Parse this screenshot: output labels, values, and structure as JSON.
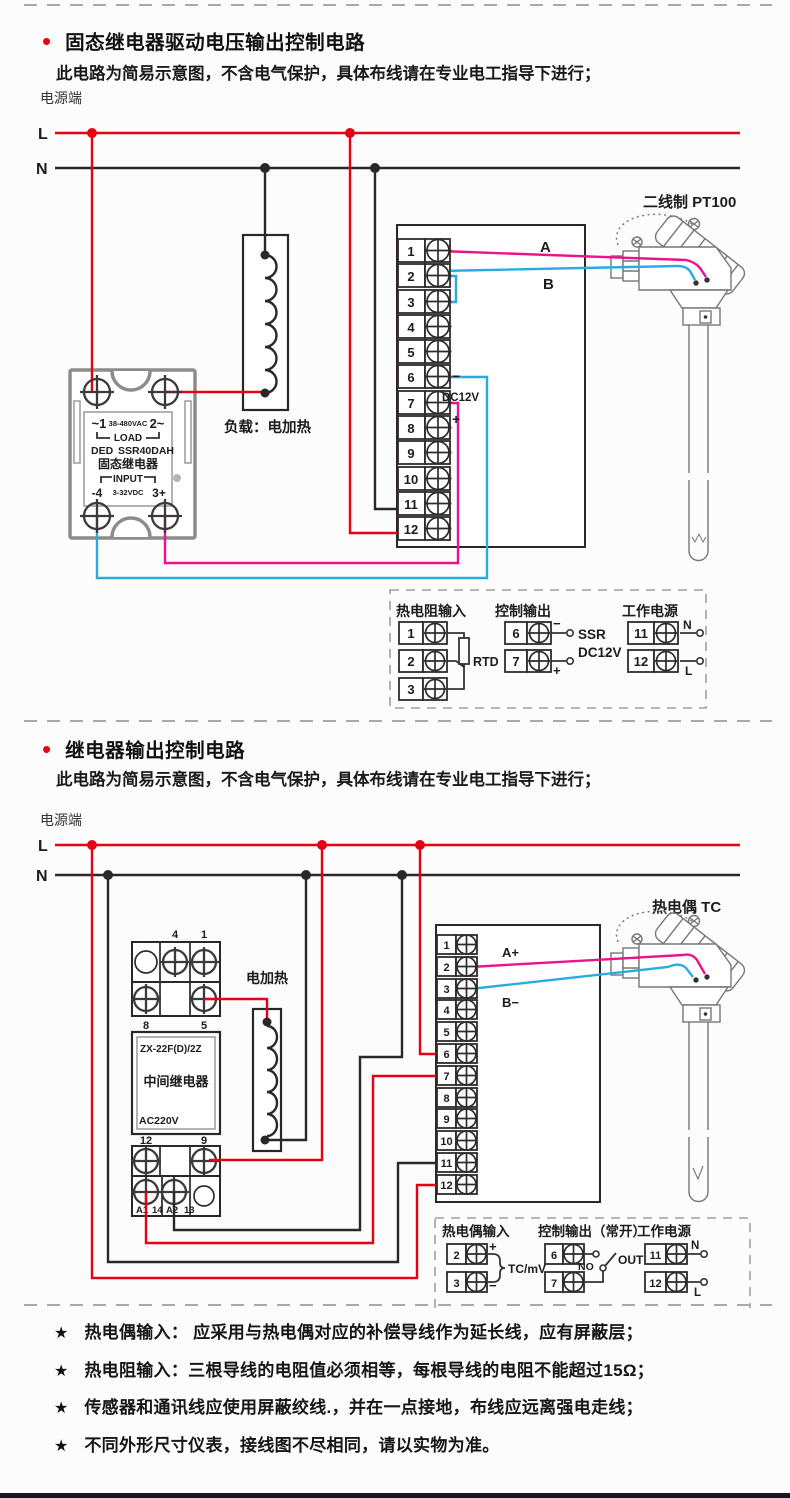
{
  "s1": {
    "bullet": "•",
    "title": "固态继电器驱动电压输出控制电路",
    "subtitle": "此电路为简易示意图，不含电气保护，具体布线请在专业电工指导下进行；",
    "power_end": "电源端",
    "l": "L",
    "n": "N",
    "t": [
      "1",
      "2",
      "3",
      "4",
      "5",
      "6",
      "7",
      "8",
      "9",
      "10",
      "11",
      "12"
    ],
    "wire_a": "A",
    "wire_b": "B",
    "minus": "−",
    "plus": "+",
    "dc12v": "DC12V",
    "ssr": {
      "pin1": "~1",
      "vac": "38-480VAC",
      "pin2": "2~",
      "load": "LOAD",
      "brand": "DED",
      "model": "SSR40DAH",
      "name": "固态继电器",
      "input": "INPUT",
      "pin4": "-4",
      "vdc": "3-32VDC",
      "pin3": "3+"
    },
    "load_label": "负载：电加热",
    "sensor_label": "二线制 PT100",
    "legend": {
      "c1_title": "热电阻输入",
      "c1_terms": [
        "1",
        "2",
        "3"
      ],
      "rtd": "RTD",
      "c2_title": "控制输出",
      "c2_terms": [
        "6",
        "7"
      ],
      "c2_minus": "−",
      "c2_plus": "+",
      "ssr": "SSR",
      "dc12v": "DC12V",
      "c3_title": "工作电源",
      "c3_terms": [
        "11",
        "12"
      ],
      "n": "N",
      "l": "L"
    }
  },
  "s2": {
    "bullet": "•",
    "title": "继电器输出控制电路",
    "subtitle": "此电路为简易示意图，不含电气保护，具体布线请在专业电工指导下进行；",
    "power_end": "电源端",
    "l": "L",
    "n": "N",
    "t": [
      "1",
      "2",
      "3",
      "4",
      "5",
      "6",
      "7",
      "8",
      "9",
      "10",
      "11",
      "12"
    ],
    "wire_a": "A+",
    "wire_b": "B−",
    "heater_label": "电加热",
    "sensor_label": "热电偶 TC",
    "relay": {
      "p4": "4",
      "p1": "1",
      "p8": "8",
      "p5": "5",
      "model": "ZX-22F(D)/2Z",
      "name": "中间继电器",
      "volt": "AC220V",
      "p12": "12",
      "p9": "9",
      "a1": "A1",
      "p14": "14",
      "a2": "A2",
      "p13": "13"
    },
    "legend": {
      "c1_title": "热电偶输入",
      "c1_terms": [
        "2",
        "3"
      ],
      "c1_plus": "+",
      "c1_minus": "−",
      "tcmv": "TC/mV",
      "c2_title": "控制输出（常开）",
      "c2_terms": [
        "6",
        "7"
      ],
      "no": "NO",
      "out": "OUT",
      "c3_title": "工作电源",
      "c3_terms": [
        "11",
        "12"
      ],
      "n": "N",
      "l": "L"
    }
  },
  "notes": [
    {
      "star": "★",
      "text": "热电偶输入： 应采用与热电偶对应的补偿导线作为延长线，应有屏蔽层；"
    },
    {
      "star": "★",
      "text": "热电阻输入：三根导线的电阻值必须相等，每根导线的电阻不能超过15Ω；"
    },
    {
      "star": "★",
      "text": "传感器和通讯线应使用屏蔽绞线.，并在一点接地，布线应远离强电走线；"
    },
    {
      "star": "★",
      "text": "不同外形尺寸仪表，接线图不尽相同，请以实物为准。"
    }
  ],
  "colors": {
    "red": "#e60012",
    "magenta": "#ec128c",
    "blue": "#29abe2",
    "wire_black": "#2b2727"
  }
}
